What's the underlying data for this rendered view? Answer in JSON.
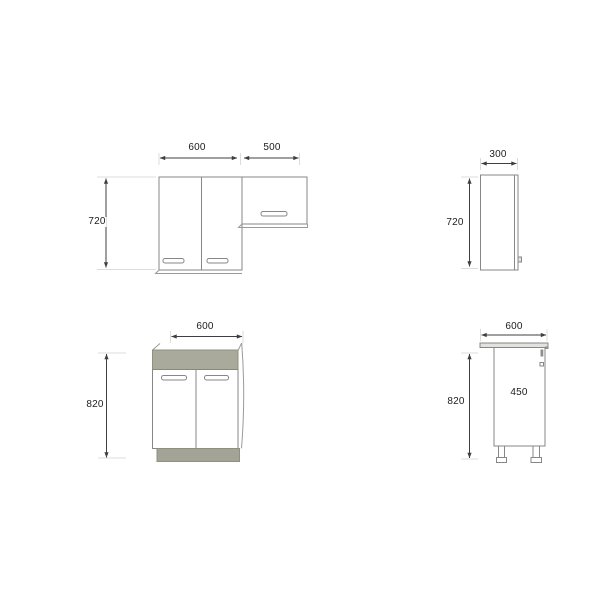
{
  "drawing": {
    "title": "kitchen-cabinet-technical-drawing",
    "views": {
      "wall_front": {
        "width_left": "600",
        "width_right": "500",
        "height": "720"
      },
      "wall_side": {
        "depth": "300",
        "height": "720"
      },
      "base_front": {
        "width": "600",
        "height": "820"
      },
      "base_side": {
        "depth": "600",
        "inner_depth": "450",
        "height": "820"
      }
    },
    "colors": {
      "background": "#ffffff",
      "object_line": "#878787",
      "dimension_line": "#3f3f3f",
      "label_text": "#1c1c1c",
      "worktop_fill": "#a9aa9b",
      "plinth_fill": "#a3a496",
      "counter_slab_fill": "#e2e2df",
      "extension_line": "#dcdcda"
    }
  }
}
